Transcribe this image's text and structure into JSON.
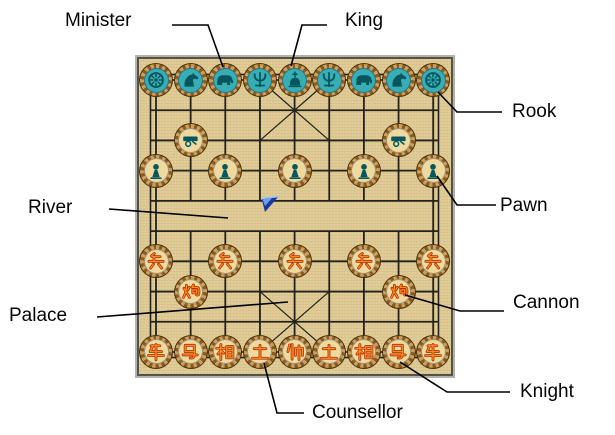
{
  "figure": {
    "description": "Xiangqi (Chinese chess) starting-position board with labelled piece names",
    "colors": {
      "board_tan": "#dfc992",
      "board_border_gray": "#53534a",
      "piece_ring_brown": "#8a5a1e",
      "black_piece_fill_cyan": "#38aeb4",
      "black_icon_teal": "#05565e",
      "cream_piece_fill": "#eeda9f",
      "red_char_orange": "#ff7a1f",
      "red_char_edge": "#b33000",
      "river_flag_blue": "#16389f"
    }
  },
  "labels": {
    "minister": "Minister",
    "king": "King",
    "rook": "Rook",
    "pawn": "Pawn",
    "river": "River",
    "palace": "Palace",
    "cannon": "Cannon",
    "knight": "Knight",
    "counsellor": "Counsellor"
  },
  "board": {
    "columns": 9,
    "rows": 10,
    "river_rows": [
      4,
      5
    ],
    "flag_icon": "river-flag-icon",
    "black_piece_icons": {
      "rook": "wheel-rook-icon",
      "knight": "horse-knight-icon",
      "minister": "elephant-minister-icon",
      "counsellor": "trident-counsellor-icon",
      "king": "orb-king-icon",
      "cannon": "cannon-icon",
      "pawn": "pawn-figure-icon"
    },
    "pieces": [
      {
        "side": "black",
        "type": "rook",
        "icon": "wheel",
        "variant": "cyan",
        "col": 0,
        "row": 0
      },
      {
        "side": "black",
        "type": "knight",
        "icon": "horse",
        "variant": "cyan",
        "col": 1,
        "row": 0
      },
      {
        "side": "black",
        "type": "minister",
        "icon": "elephant",
        "variant": "cyan",
        "col": 2,
        "row": 0
      },
      {
        "side": "black",
        "type": "counsellor",
        "icon": "trident",
        "variant": "cyan",
        "col": 3,
        "row": 0
      },
      {
        "side": "black",
        "type": "king",
        "icon": "orb",
        "variant": "cyan",
        "col": 4,
        "row": 0
      },
      {
        "side": "black",
        "type": "counsellor",
        "icon": "trident",
        "variant": "cyan",
        "col": 5,
        "row": 0
      },
      {
        "side": "black",
        "type": "minister",
        "icon": "elephant",
        "variant": "cyan",
        "col": 6,
        "row": 0
      },
      {
        "side": "black",
        "type": "knight",
        "icon": "horse",
        "variant": "cyan",
        "col": 7,
        "row": 0
      },
      {
        "side": "black",
        "type": "rook",
        "icon": "wheel",
        "variant": "cyan",
        "col": 8,
        "row": 0
      },
      {
        "side": "black",
        "type": "cannon",
        "icon": "cannon",
        "variant": "cream",
        "col": 1,
        "row": 2
      },
      {
        "side": "black",
        "type": "cannon",
        "icon": "cannon",
        "variant": "cream",
        "col": 7,
        "row": 2
      },
      {
        "side": "black",
        "type": "pawn",
        "icon": "pawnfig",
        "variant": "cream",
        "col": 0,
        "row": 3
      },
      {
        "side": "black",
        "type": "pawn",
        "icon": "pawnfig",
        "variant": "cream",
        "col": 2,
        "row": 3
      },
      {
        "side": "black",
        "type": "pawn",
        "icon": "pawnfig",
        "variant": "cream",
        "col": 4,
        "row": 3
      },
      {
        "side": "black",
        "type": "pawn",
        "icon": "pawnfig",
        "variant": "cream",
        "col": 6,
        "row": 3
      },
      {
        "side": "black",
        "type": "pawn",
        "icon": "pawnfig",
        "variant": "cream",
        "col": 8,
        "row": 3
      },
      {
        "side": "red",
        "type": "pawn",
        "char": "兵",
        "variant": "cream",
        "col": 0,
        "row": 6
      },
      {
        "side": "red",
        "type": "pawn",
        "char": "兵",
        "variant": "cream",
        "col": 2,
        "row": 6
      },
      {
        "side": "red",
        "type": "pawn",
        "char": "兵",
        "variant": "cream",
        "col": 4,
        "row": 6
      },
      {
        "side": "red",
        "type": "pawn",
        "char": "兵",
        "variant": "cream",
        "col": 6,
        "row": 6
      },
      {
        "side": "red",
        "type": "pawn",
        "char": "兵",
        "variant": "cream",
        "col": 8,
        "row": 6
      },
      {
        "side": "red",
        "type": "cannon",
        "char": "炮",
        "variant": "cream",
        "col": 1,
        "row": 7
      },
      {
        "side": "red",
        "type": "cannon",
        "char": "炮",
        "variant": "cream",
        "col": 7,
        "row": 7
      },
      {
        "side": "red",
        "type": "rook",
        "char": "车",
        "variant": "cream",
        "col": 0,
        "row": 9
      },
      {
        "side": "red",
        "type": "knight",
        "char": "马",
        "variant": "cream",
        "col": 1,
        "row": 9
      },
      {
        "side": "red",
        "type": "minister",
        "char": "相",
        "variant": "cream",
        "col": 2,
        "row": 9
      },
      {
        "side": "red",
        "type": "counsellor",
        "char": "士",
        "variant": "cream",
        "col": 3,
        "row": 9
      },
      {
        "side": "red",
        "type": "king",
        "char": "帅",
        "variant": "cream",
        "col": 4,
        "row": 9
      },
      {
        "side": "red",
        "type": "counsellor",
        "char": "士",
        "variant": "cream",
        "col": 5,
        "row": 9
      },
      {
        "side": "red",
        "type": "minister",
        "char": "相",
        "variant": "cream",
        "col": 6,
        "row": 9
      },
      {
        "side": "red",
        "type": "knight",
        "char": "马",
        "variant": "cream",
        "col": 7,
        "row": 9
      },
      {
        "side": "red",
        "type": "rook",
        "char": "车",
        "variant": "cream",
        "col": 8,
        "row": 9
      }
    ]
  }
}
